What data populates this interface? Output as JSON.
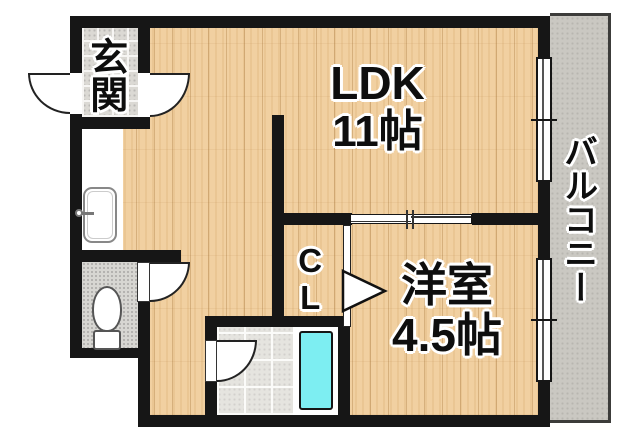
{
  "floorplan": {
    "type": "apartment-1LDK-floor-plan",
    "rooms": {
      "ldk": {
        "name": "LDK",
        "size": "11帖"
      },
      "western_room": {
        "name": "洋室",
        "size": "4.5帖"
      },
      "entrance": {
        "name": "玄関"
      },
      "closet": {
        "name": "CL"
      },
      "balcony": {
        "name": "バルコニー"
      }
    },
    "icons": {
      "toilet": "toilet-icon",
      "sink": "sink-icon",
      "bathtub": "bathtub-icon",
      "door": "door-swing-icon",
      "window": "sliding-window-icon",
      "sliding_door": "sliding-door-icon",
      "closet_door": "closet-door-triangle-icon"
    },
    "colors": {
      "wall": "#161616",
      "wood_floor": "#f1d0a1",
      "entrance_tile": "#dbd9d4",
      "toilet_floor": "#d7d6d2",
      "bath_floor": "#e5e4df",
      "bathtub_cyan": "#7deef2",
      "balcony_concrete": "#cac8c2"
    }
  }
}
